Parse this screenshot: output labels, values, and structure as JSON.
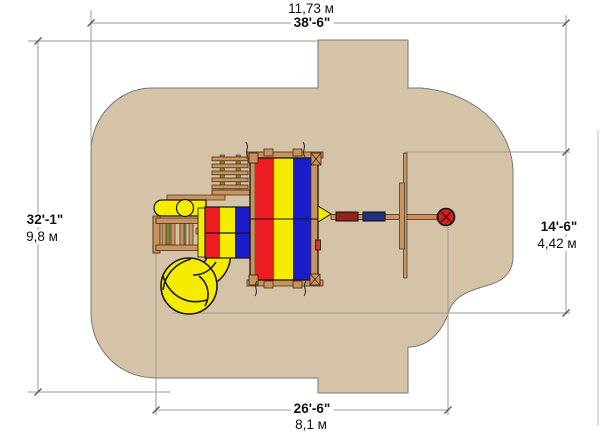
{
  "diagram": {
    "description": "Playground equipment plan (top view) with safety-surface zone and overall dimensions",
    "surface_color": "#d5c3a8",
    "colors": {
      "canopy_red": "#ee1c23",
      "canopy_yellow": "#f6ec00",
      "canopy_blue": "#1b1ec8",
      "wood": "#c8935f",
      "olive_rail": "#808238",
      "swing_seat_red": "#8e2320",
      "swing_seat_blue": "#20307e",
      "tire_swing_red": "#cb2420",
      "dimension_line": "#999999"
    },
    "dimensions": {
      "top": {
        "metric": "11,73 м",
        "imperial": "38'-6\""
      },
      "left": {
        "imperial": "32'-1\"",
        "metric": "9,8 м"
      },
      "right": {
        "imperial": "14'-6\"",
        "metric": "4,42 м"
      },
      "bottom": {
        "imperial": "26'-6\"",
        "metric": "8,1 м"
      }
    },
    "components": [
      "safety-surface-zone",
      "monkey-bars",
      "large-striped-canopy",
      "swing-beam",
      "swing-seats",
      "tire-swing",
      "small-striped-canopy",
      "straight-slide",
      "access-ladder",
      "spiral-tube-slide"
    ]
  }
}
